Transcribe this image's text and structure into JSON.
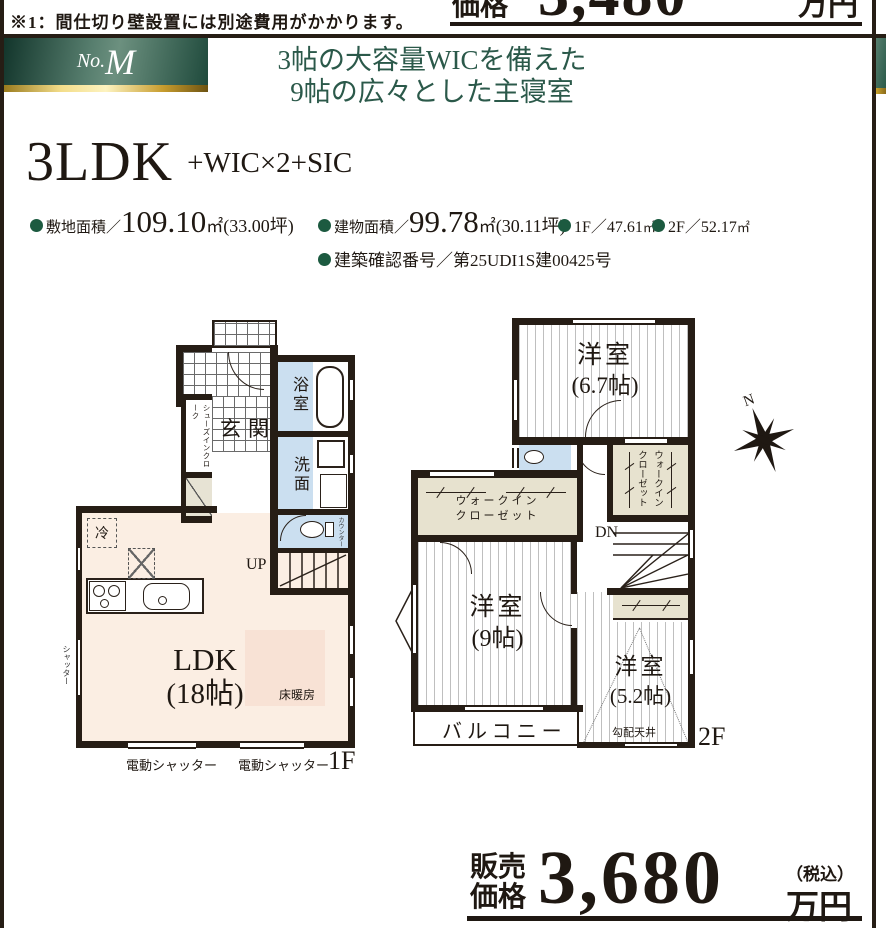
{
  "colors": {
    "wall": "#261d15",
    "room_blue": "#cbdff0",
    "room_beige": "#e7e2cf",
    "ldk_cream": "#fbeee3",
    "floor_heating": "#f8e2d5",
    "banner_green_dark": "#12352b",
    "banner_green_light": "#6c907f",
    "title_green": "#2b594a",
    "bullet_green": "#1c5a40",
    "gold": "#e7c763"
  },
  "top": {
    "note": "※1：間仕切り壁設置には別途費用がかかります。",
    "price_label": "価格",
    "price_amount": "3,480",
    "price_unit": "万円"
  },
  "banner": {
    "no_prefix": "No.",
    "no_value": "M",
    "title_line1": "3帖の大容量WICを備えた",
    "title_line2": "9帖の広々とした主寝室"
  },
  "plan": {
    "layout": "3LDK",
    "layout_suffix": "+WIC×2+SIC"
  },
  "specs": {
    "land_label": "敷地面積／",
    "land_value": "109.10",
    "land_unit": "㎡",
    "land_tsubo": "(33.00坪)",
    "bldg_label": "建物面積／",
    "bldg_value": "99.78",
    "bldg_unit": "㎡",
    "bldg_tsubo": "(30.11坪)",
    "f1_label": "1F／",
    "f1_value": "47.61",
    "f1_unit": "㎡",
    "f2_label": "2F／",
    "f2_value": "52.17",
    "f2_unit": "㎡",
    "permit": "建築確認番号／第25UDI1S建00425号"
  },
  "floor1": {
    "label": "1F",
    "genkan": "玄関",
    "sic": "シューズインクローク",
    "bath": "浴室",
    "wash": "洗面",
    "counter": "カウンター",
    "up": "UP",
    "fridge": "冷",
    "ldk": "LDK",
    "ldk_size": "(18帖)",
    "floor_heating": "床暖房",
    "shutter_side": "シャッター",
    "shutter1": "電動シャッター",
    "shutter2": "電動シャッター"
  },
  "floor2": {
    "label": "2F",
    "room1": "洋室",
    "room1_size": "(6.7帖)",
    "wic1_line1": "ウォークイン",
    "wic1_line2": "クローゼット",
    "wic2_line1": "ウォークイン",
    "wic2_line2": "クローゼット",
    "dn": "DN",
    "room2": "洋室",
    "room2_size": "(9帖)",
    "room3": "洋室",
    "room3_size": "(5.2帖)",
    "sloped_ceiling": "勾配天井",
    "balcony": "バルコニー",
    "north": "N"
  },
  "price": {
    "label_line1": "販売",
    "label_line2": "価格",
    "amount": "3,680",
    "tax_note": "（税込）",
    "unit": "万円"
  }
}
